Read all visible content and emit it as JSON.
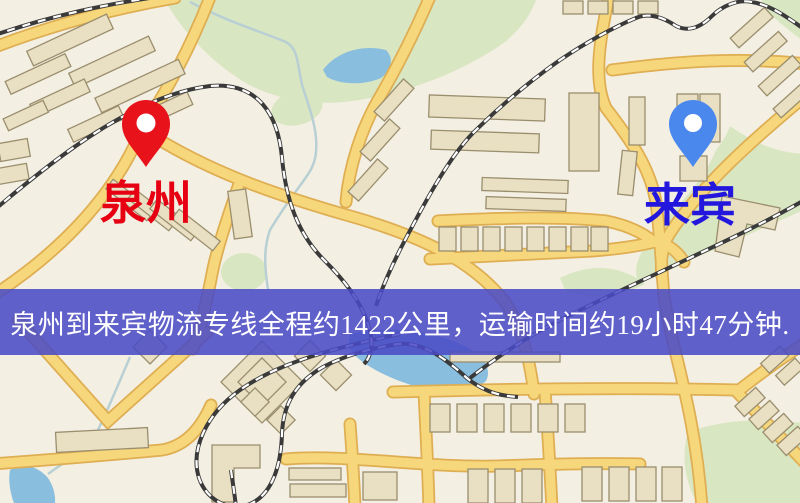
{
  "banner": {
    "text": "泉州到来宾物流专线全程约1422公里，运输时间约19小时47分钟.",
    "bg_color": "#494bc5",
    "text_color": "#ffffff"
  },
  "markers": {
    "origin": {
      "label": "泉州",
      "pin_color": "#e8121a",
      "label_color": "#e60012"
    },
    "destination": {
      "label": "来宾",
      "pin_color": "#4a88ee",
      "label_color": "#2417dd"
    }
  },
  "map": {
    "colors": {
      "background": "#f3efe2",
      "road": "#f6d77c",
      "road_casing": "#dfae52",
      "building": "#e9dfc2",
      "building_outline": "#9a8e6e",
      "green": "#d9e6c2",
      "water": "#8abede",
      "stream": "#b8cfd4",
      "railway": "#3a3a3a"
    }
  }
}
